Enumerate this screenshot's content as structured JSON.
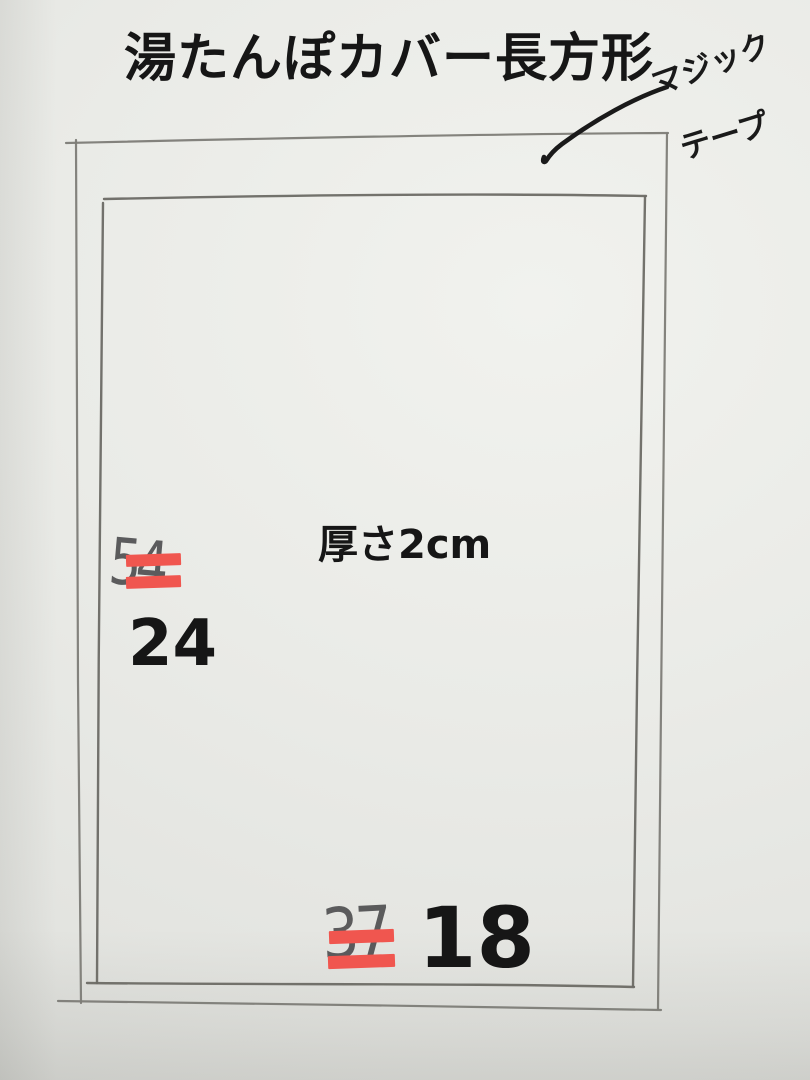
{
  "title": "湯たんぽカバー長方形",
  "labels": {
    "velcro_line1": "マジック",
    "velcro_line2": "テープ",
    "velcro_full": "マジックテープ",
    "thickness": "厚さ2cm"
  },
  "measurements": {
    "left_side": {
      "value": "24",
      "crossed_out": "54"
    },
    "bottom_side": {
      "value": "18",
      "crossed_out": "37"
    }
  },
  "colors": {
    "paper": "#e9eae6",
    "pencil": "#7d7c77",
    "pencil_dark": "#6b6a65",
    "ink": "#1a1a1a",
    "text": "#161616",
    "strike": "#f0564f",
    "crossed": "#48484a"
  }
}
